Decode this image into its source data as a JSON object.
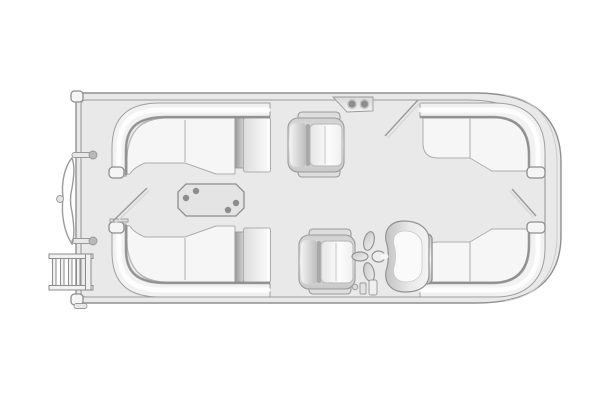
{
  "diagram": {
    "type": "floorplan",
    "subject": "pontoon-boat-deck-layout-top-view",
    "bow_side": "left",
    "stern_side": "right"
  },
  "palette": {
    "background": "#ffffff",
    "deck": "#e9e9e9",
    "hull_line": "#8f8f8f",
    "fence_line": "#9c9c9c",
    "band_fill": "#f2f2f2",
    "band_shadow": "#8a8a8a",
    "highlight": "#ffffff",
    "cushion": "#f6f6f6",
    "cushion_edge": "#adadad",
    "cap_fill": "#f5f5f5",
    "table_fill": "#e4e4e4",
    "cupholder": "#8d8d8d",
    "gate_line": "#9a9a9a",
    "ladder_fill": "#f1f1f1",
    "motor_inner": "#fafafa",
    "hub_fill": "#ededed",
    "fitting_fill": "#e8e8e8",
    "nose_fill": "#f3f3f3"
  },
  "components": [
    {
      "name": "hull",
      "role": "deck outline with rounded stern corners"
    },
    {
      "name": "center-pontoon-nose",
      "role": "nose cone protruding at left (bow)"
    },
    {
      "name": "boarding-ladder",
      "role": "ladder at lower-left, 4 rungs"
    },
    {
      "name": "lounge-top-left",
      "role": "wraparound corner lounge with end seat"
    },
    {
      "name": "lounge-bottom-left",
      "role": "wraparound corner lounge with end seat"
    },
    {
      "name": "lounge-top-right",
      "role": "wraparound corner lounge"
    },
    {
      "name": "lounge-bottom-right",
      "role": "wraparound corner lounge with armrest"
    },
    {
      "name": "helm-chair-upper",
      "role": "captain chair, top center"
    },
    {
      "name": "helm-chair-lower",
      "role": "captain chair, bottom center"
    },
    {
      "name": "cupholder-console",
      "role": "bracket with 2 cupholders at top rail",
      "cupholders": 2
    },
    {
      "name": "dining-table",
      "role": "octagonal table with cupholders",
      "cupholders": 4
    },
    {
      "name": "outboard-motor",
      "role": "motor cowling with propeller",
      "propeller_blades": 3
    },
    {
      "name": "gate-left",
      "role": "open gate shown as diagonal"
    },
    {
      "name": "gate-top",
      "role": "open gate shown as diagonal"
    },
    {
      "name": "gate-right",
      "role": "open gate shown as diagonal"
    }
  ]
}
